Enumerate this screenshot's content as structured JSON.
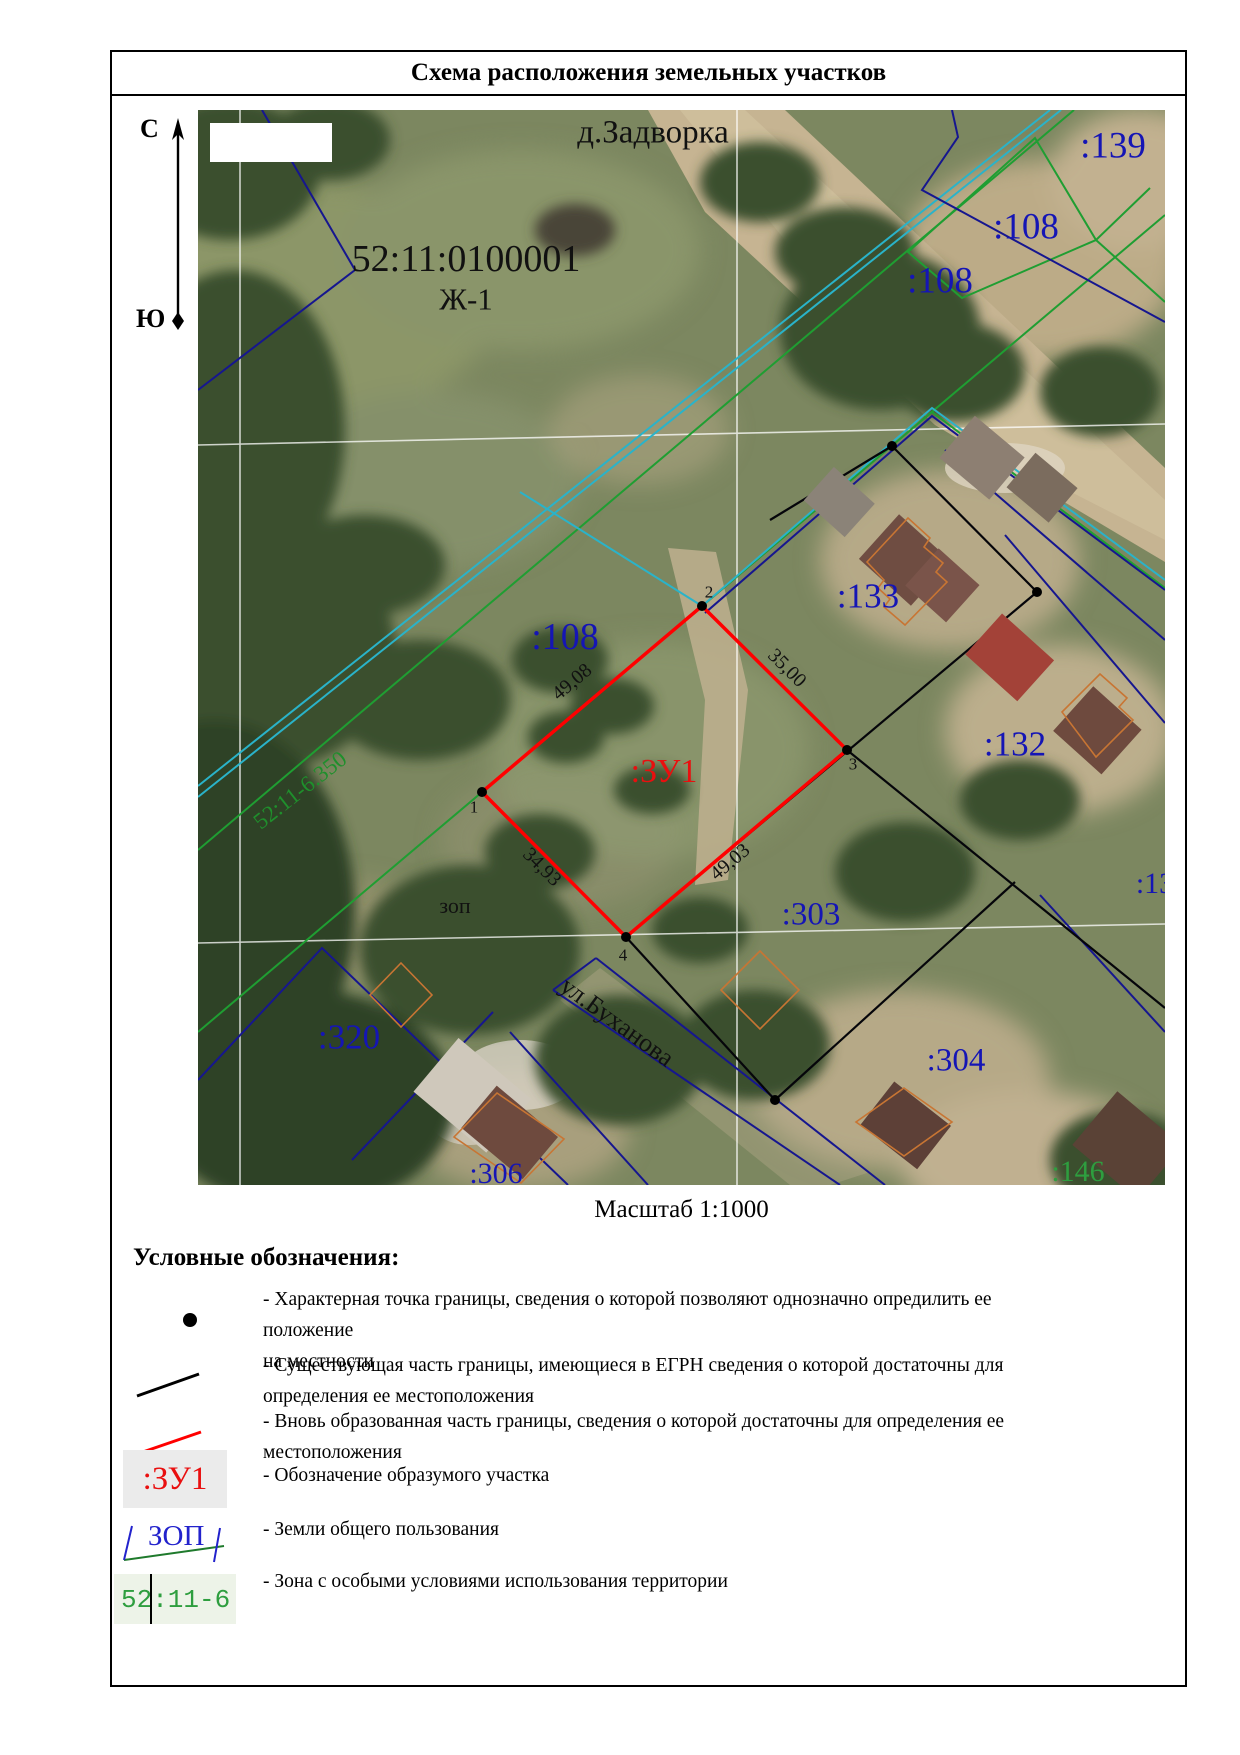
{
  "doc": {
    "title": "Схема расположения земельных участков",
    "scale_label": "Масштаб 1:1000"
  },
  "compass": {
    "north": "С",
    "south": "Ю"
  },
  "map": {
    "settlement": "д.Задворка",
    "quarter_number": "52:11:0100001",
    "territorial_zone": "Ж-1",
    "zone_line_label": "52:11-6.350",
    "street": "ул.Буханова",
    "common_land": "зоп",
    "new_parcel": ":ЗУ1",
    "parcels": {
      "p139": ":139",
      "p108a": ":108",
      "p108b": ":108",
      "p108c": ":108",
      "p133": ":133",
      "p132": ":132",
      "p303": ":303",
      "p304": ":304",
      "p320": ":320",
      "p306": ":306",
      "p146": ":146",
      "p13": ":13"
    },
    "dimensions": {
      "d12": "49,08",
      "d23": "35,00",
      "d14": "34,93",
      "d43": "49,03"
    },
    "vertices": {
      "v1": "1",
      "v2": "2",
      "v3": "3",
      "v4": "4"
    }
  },
  "legend": {
    "header": "Условные обозначения:",
    "items": [
      {
        "line1": "- Характерная точка границы, сведения о которой позволяют однозначно опредилить ее положение",
        "line2": "на местности"
      },
      {
        "line1": "- Существующая часть границы, имеющиеся в ЕГРН сведения о которой достаточны для",
        "line2": "определения ее местоположения"
      },
      {
        "line1": "- Вновь образованная часть границы, сведения о которой достаточны для определения ее",
        "line2": "местоположения"
      },
      {
        "line1": "- Обозначение образумого участка",
        "line2": ""
      },
      {
        "line1": "- Земли общего пользования",
        "line2": ""
      },
      {
        "line1": "- Зона с особыми условиями использования территории",
        "line2": ""
      }
    ],
    "zu1_swatch": ":ЗУ1",
    "zop_swatch": "ЗОП",
    "zone_swatch": "52:11-6"
  },
  "colors": {
    "parcel_label_blue": "#1515b5",
    "new_parcel_red": "#ff0000",
    "zone_green": "#1f9e32",
    "quarter_navy": "#16168f",
    "zone_cyan": "#2ab3c9",
    "existing_black": "#05050a"
  }
}
